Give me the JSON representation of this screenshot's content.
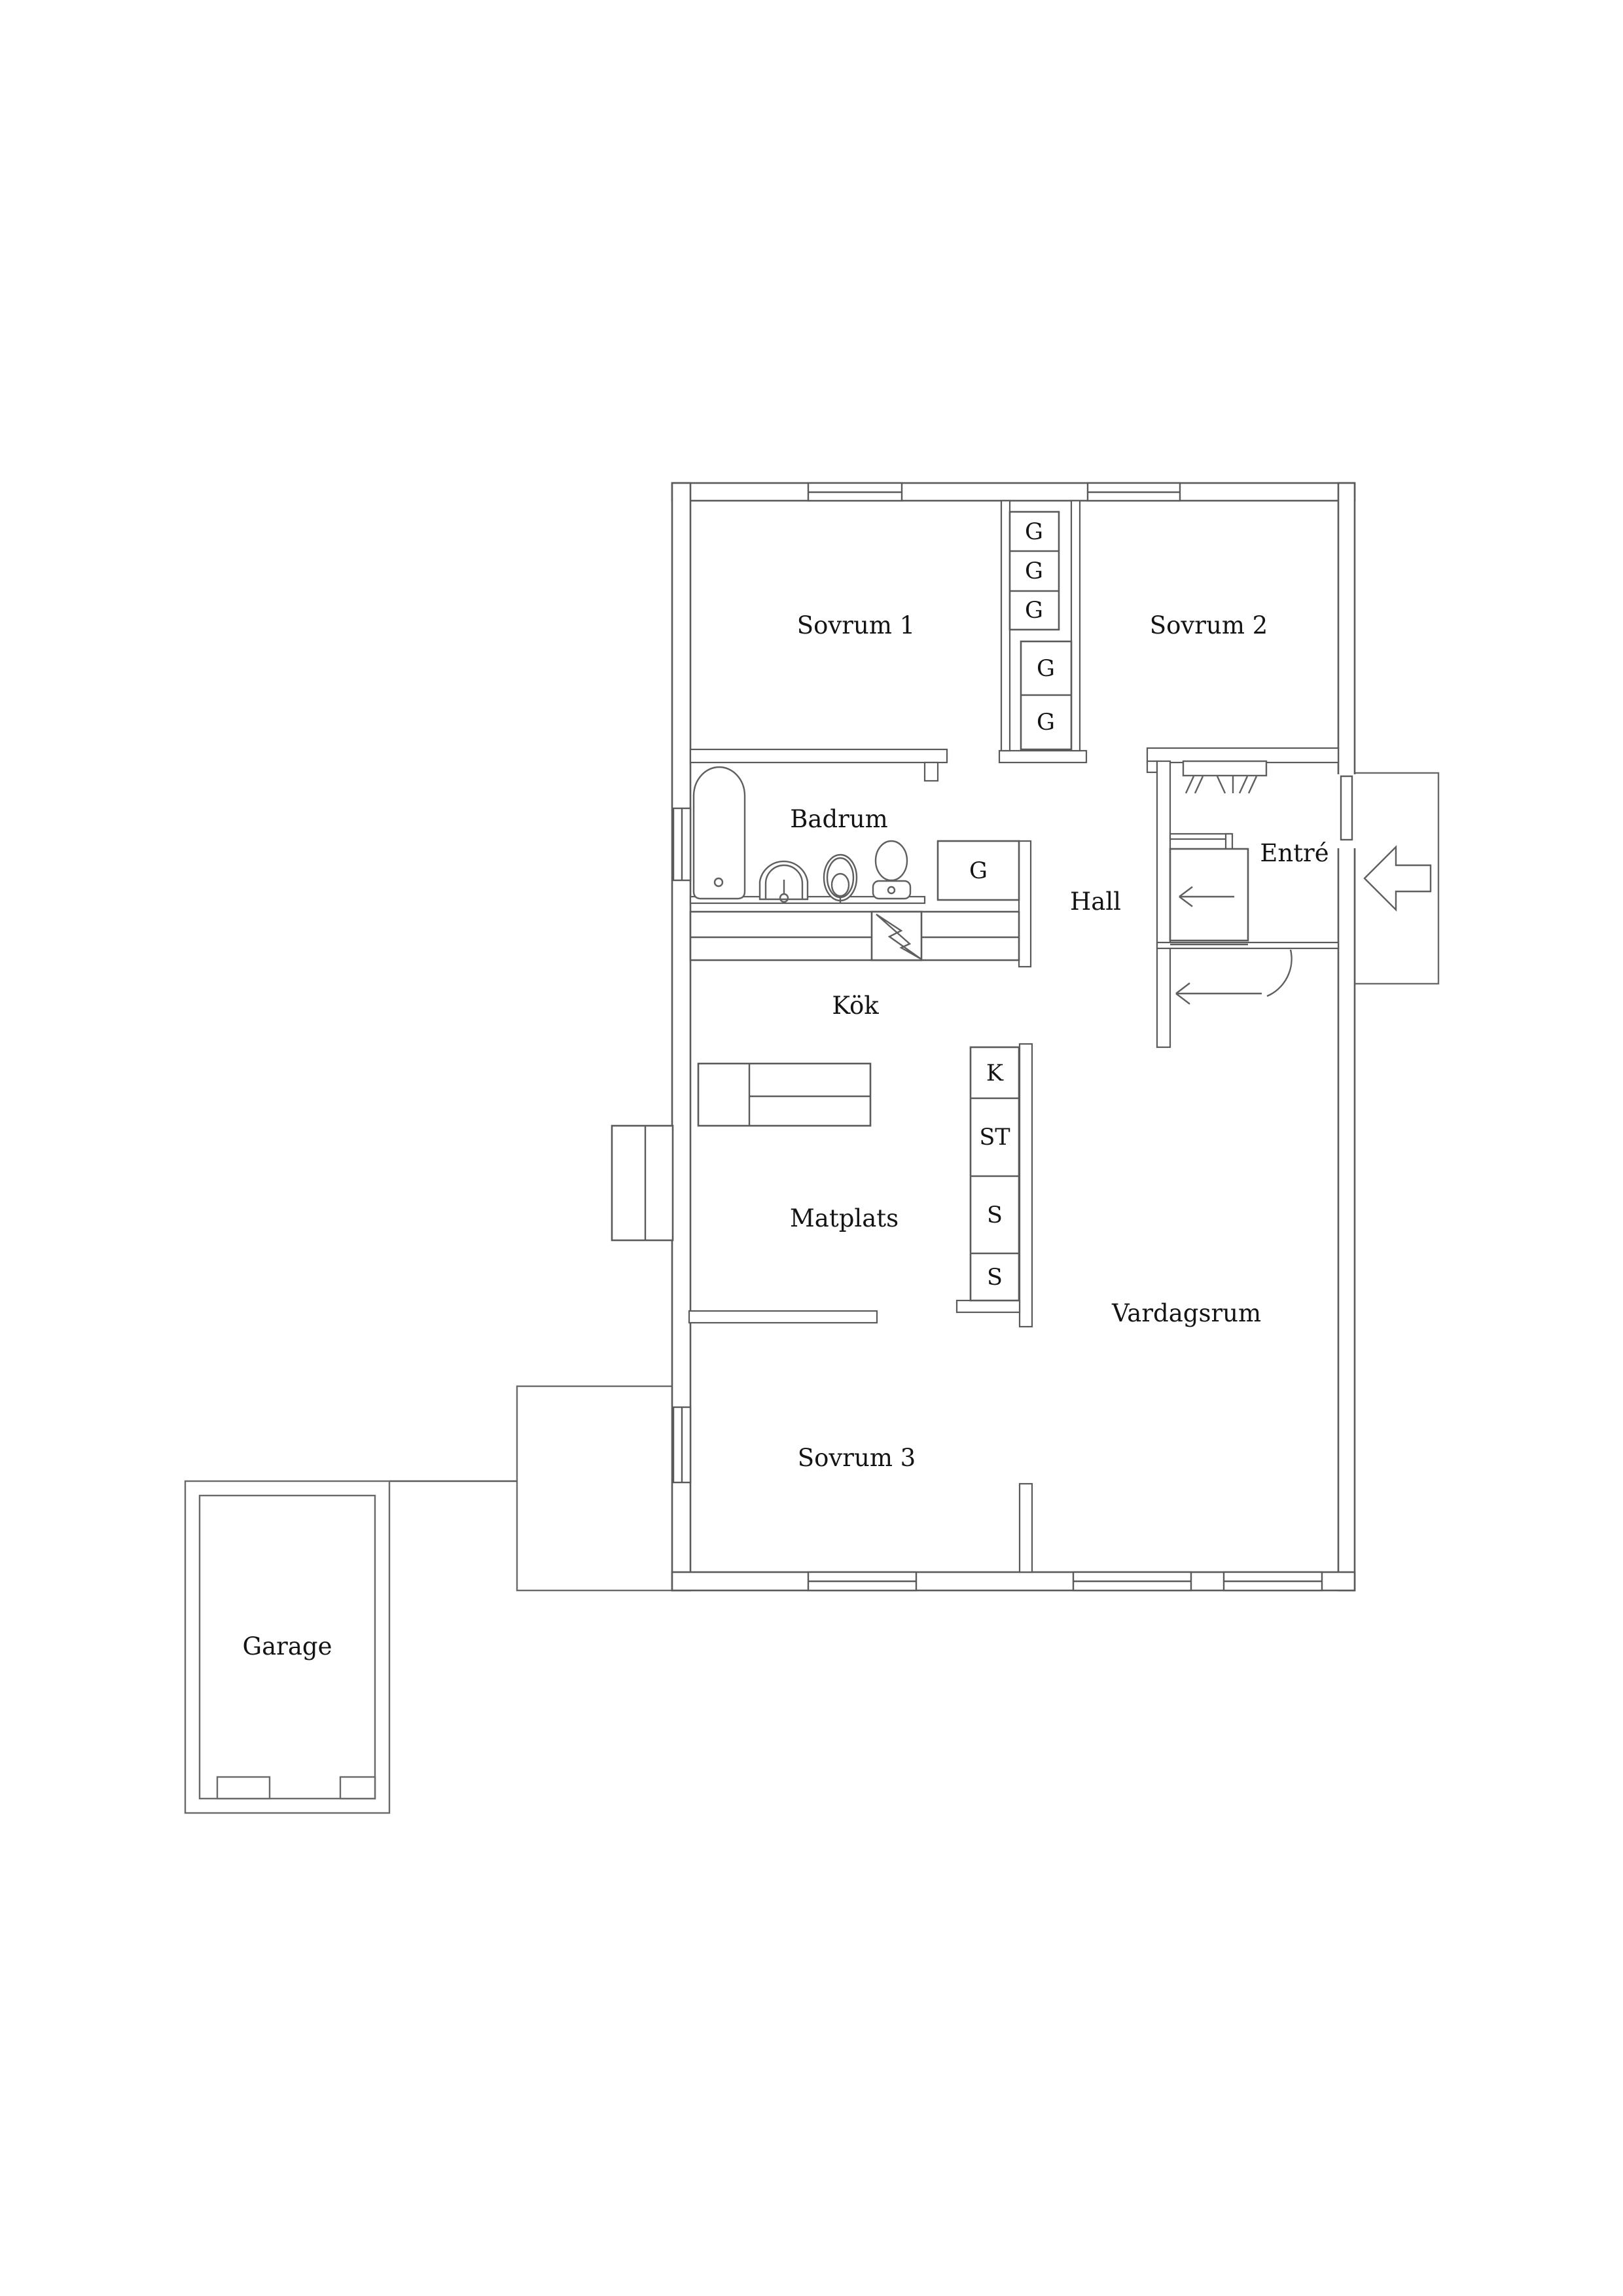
{
  "colors": {
    "background": "#ffffff",
    "wall_line": "#5a5a5a",
    "text": "#141414"
  },
  "floor_plan": {
    "rooms": [
      {
        "id": "sovrum-1",
        "label": "Sovrum 1"
      },
      {
        "id": "sovrum-2",
        "label": "Sovrum 2"
      },
      {
        "id": "badrum",
        "label": "Badrum"
      },
      {
        "id": "hall",
        "label": "Hall"
      },
      {
        "id": "entre",
        "label": "Entré"
      },
      {
        "id": "kok",
        "label": "Kök"
      },
      {
        "id": "matplats",
        "label": "Matplats"
      },
      {
        "id": "vardagsrum",
        "label": "Vardagsrum"
      },
      {
        "id": "sovrum-3",
        "label": "Sovrum 3"
      },
      {
        "id": "garage",
        "label": "Garage"
      }
    ],
    "wardrobes": {
      "upper_small": [
        "G",
        "G",
        "G"
      ],
      "upper_large": [
        "G",
        "G"
      ],
      "bathroom": "G",
      "storage_column": [
        "K",
        "ST",
        "S",
        "S"
      ]
    }
  }
}
